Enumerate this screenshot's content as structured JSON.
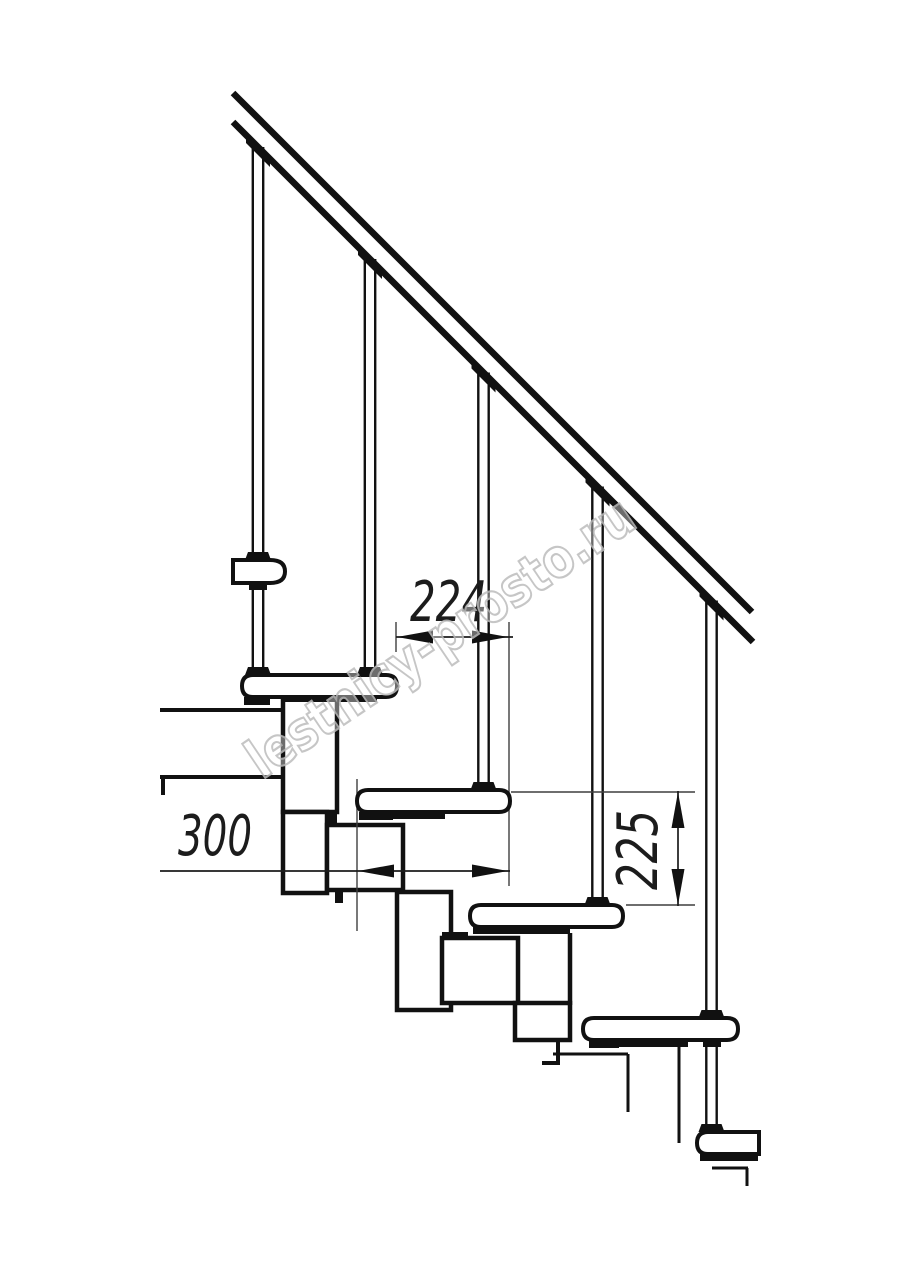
{
  "drawing": {
    "title": "modular-staircase-side-view",
    "dimensions": {
      "run": {
        "value": "224",
        "orientation": "horizontal"
      },
      "depth": {
        "value": "300",
        "orientation": "horizontal"
      },
      "rise": {
        "value": "225",
        "orientation": "vertical"
      }
    },
    "watermark": {
      "text": "lestnicy-prosto.ru",
      "color": "#bdbdbd"
    },
    "colors": {
      "background": "#ffffff",
      "line": "#111111",
      "extension_line": "#3f3f3f"
    },
    "counts": {
      "balusters": 5,
      "treads_visible": 5
    }
  }
}
